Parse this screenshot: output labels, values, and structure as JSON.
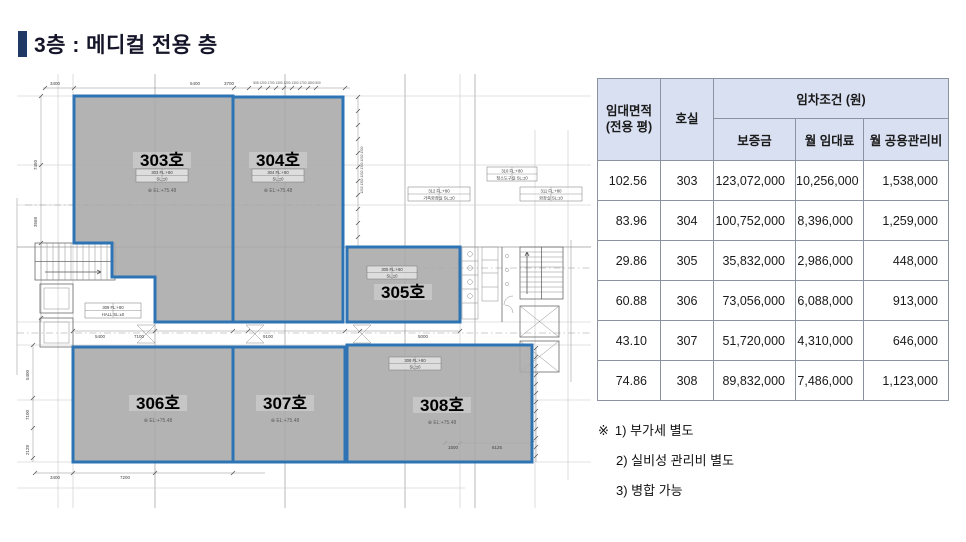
{
  "title": {
    "text": "3층 : 메디컬 전용 층"
  },
  "accent_color": "#1f3864",
  "room_border_color": "#2e74b5",
  "room_fill_color": "#a9a9a9",
  "header_bg_color": "#d9e0f2",
  "table": {
    "col1_header_line1": "임대면적",
    "col1_header_line2": "(전용 평)",
    "col2_header": "호실",
    "group_header": "임차조건 (원)",
    "sub_headers": [
      "보증금",
      "월 임대료",
      "월 공용관리비"
    ],
    "rows": [
      [
        "102.56",
        "303",
        "123,072,000",
        "10,256,000",
        "1,538,000"
      ],
      [
        "83.96",
        "304",
        "100,752,000",
        "8,396,000",
        "1,259,000"
      ],
      [
        "29.86",
        "305",
        "35,832,000",
        "2,986,000",
        "448,000"
      ],
      [
        "60.88",
        "306",
        "73,056,000",
        "6,088,000",
        "913,000"
      ],
      [
        "43.10",
        "307",
        "51,720,000",
        "4,310,000",
        "646,000"
      ],
      [
        "74.86",
        "308",
        "89,832,000",
        "7,486,000",
        "1,123,000"
      ]
    ]
  },
  "notes": {
    "marker": "※",
    "items": [
      "1) 부가세 별도",
      "2) 실비성 관리비 별도",
      "3) 병합 가능"
    ]
  },
  "plan": {
    "rooms": [
      {
        "label": "303호",
        "el": "⊕ EL:+75.48"
      },
      {
        "label": "304호",
        "el": "⊕ EL:+75.48"
      },
      {
        "label": "305호",
        "el": ""
      },
      {
        "label": "306호",
        "el": "⊕ EL:+75.48"
      },
      {
        "label": "307호",
        "el": "⊕ EL:+75.48"
      },
      {
        "label": "308호",
        "el": "⊕ EL:+75.48"
      }
    ],
    "tags": [
      {
        "l1": "303  FL:+80",
        "l2": "SL:±0"
      },
      {
        "l1": "304  FL:+80",
        "l2": "SL:±0"
      },
      {
        "l1": "305  FL:+80",
        "l2": "SL:±0"
      },
      {
        "l1": "308  FL:+80",
        "l2": "SL:±0"
      },
      {
        "l1": "309  FL:+80",
        "l2": "HALL  SL:±0"
      },
      {
        "l1": "310  FL:+80",
        "l2": "청소도구실  SL:±0"
      },
      {
        "l1": "312  FL:+80",
        "l2": "가족화장실  SL:±0"
      },
      {
        "l1": "311  FL:+80",
        "l2": "화장실  SL:±0"
      }
    ],
    "dims": [
      "3400",
      "5400",
      "3700",
      "508 1200 1700 1300 1200 1300 1700 1800 500",
      "7450",
      "3568",
      "5400",
      "7100",
      "9100",
      "5000",
      "3400",
      "7200",
      "1500",
      "6125",
      "5400",
      "7100",
      "2128",
      "1200 1300 1200 1300 1200 1300"
    ]
  }
}
